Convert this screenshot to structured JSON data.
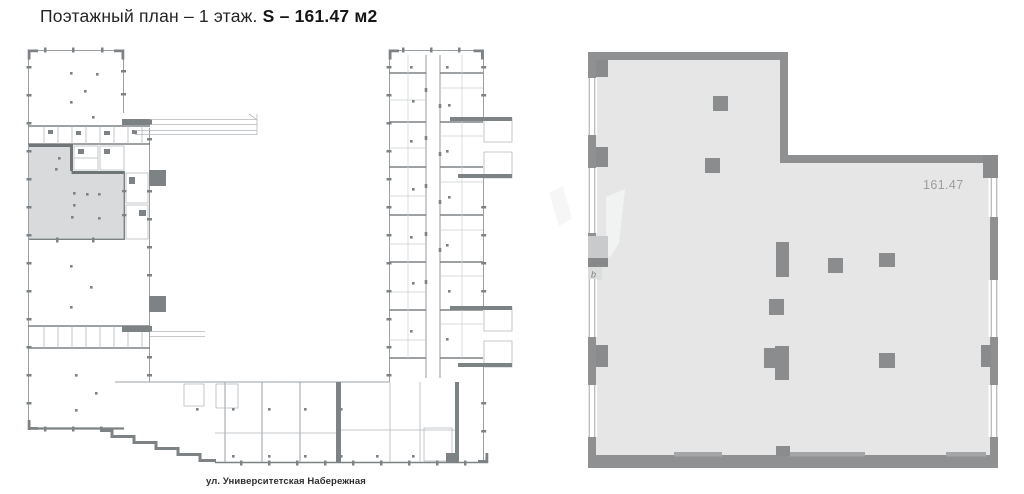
{
  "header": {
    "title_regular": "Поэтажный план – 1 этаж.",
    "title_bold": "S – 161.47 м2"
  },
  "overview_plan": {
    "street_label": "ул. Университетская Набережная",
    "highlight_color": "#d9dadb"
  },
  "detail_plan": {
    "area_label": "161.47",
    "entry_marker": "b",
    "wall_color": "#8f9092",
    "floor_color": "#e6e6e7",
    "window_frame_color": "#9b9c9e",
    "light_wall_color": "#a4a5a7"
  }
}
